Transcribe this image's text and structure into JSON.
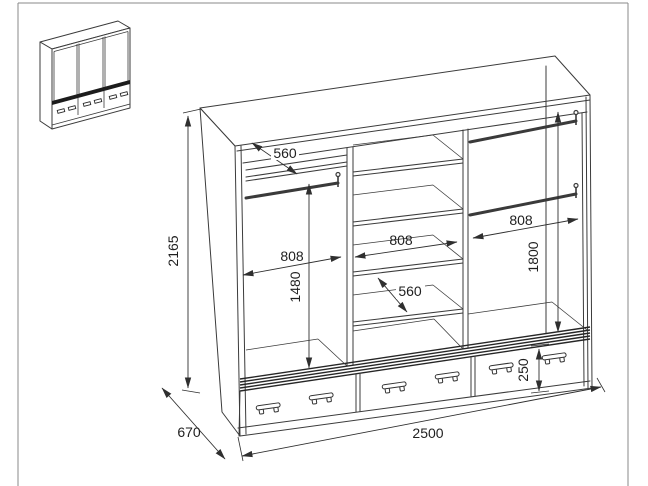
{
  "dimensions": {
    "total_height": "2165",
    "total_width": "2500",
    "depth": "670",
    "left_shelf_depth": "560",
    "left_section_width": "808",
    "left_hanging_height": "1480",
    "middle_section_width": "808",
    "middle_shelf_depth": "560",
    "right_section_width": "808",
    "right_hanging_height": "1800",
    "drawer_height": "250"
  },
  "colors": {
    "line": "#3b3b3b",
    "dim_line": "#2f2f2f",
    "text": "#1f1f1f",
    "frame": "#8a8a8a",
    "background": "#ffffff"
  }
}
